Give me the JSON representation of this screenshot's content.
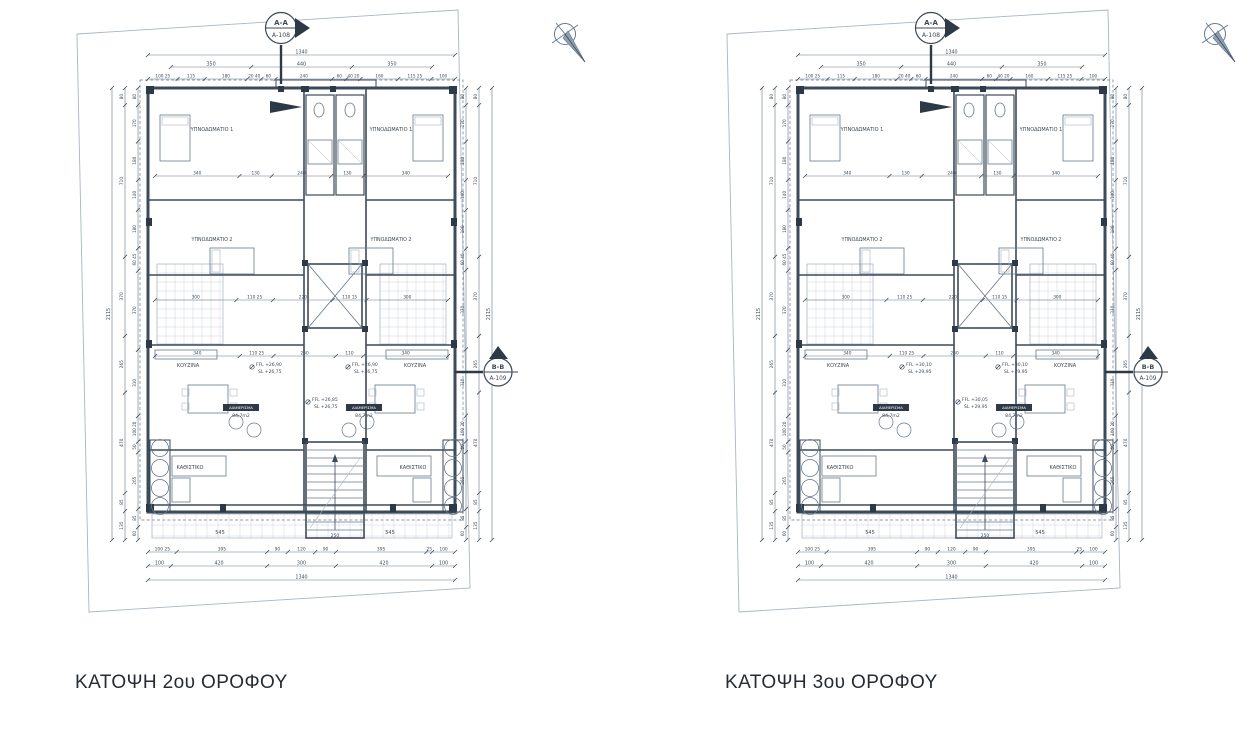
{
  "colors": {
    "line_dark": "#3d4a58",
    "line_med": "#64788c",
    "line_light": "#a8b6c4",
    "hatch": "#c5cfd9",
    "fill_dark": "#2e3948",
    "title_text": "#262c34",
    "paper": "#ffffff"
  },
  "plans": [
    {
      "title": "ΚΑΤΟΨΗ 2ου ΟΡΟΦΟΥ",
      "marker_top": {
        "name": "A-A",
        "sheet": "A-108"
      },
      "marker_side": {
        "name": "B-B",
        "sheet": "A-109"
      },
      "levels": {
        "unit_ffl": "FFL +26,90",
        "unit_sl": "SL +26,75",
        "core_ffl": "FFL +26,85",
        "core_sl": "SL +26,75"
      }
    },
    {
      "title": "ΚΑΤΟΨΗ 3ου ΟΡΟΦΟΥ",
      "marker_top": {
        "name": "A-A",
        "sheet": "A-108"
      },
      "marker_side": {
        "name": "B-B",
        "sheet": "A-109"
      },
      "levels": {
        "unit_ffl": "FFL +30,10",
        "unit_sl": "SL +29,95",
        "core_ffl": "FFL +30,05",
        "core_sl": "SL +29,95"
      }
    }
  ],
  "shared": {
    "room_labels": {
      "bedroom1": "ΥΠΝΟΔΩΜΑΤΙΟ 1",
      "bedroom2": "ΥΠΝΟΔΩΜΑΤΙΟ 2",
      "kitchen": "ΚΟΥΖΙΝΑ",
      "living": "ΚΑΘΙΣΤΙΚΟ"
    },
    "apartment": {
      "label": "ΔΙΑΜΕΡΙΣΜΑ",
      "area": "84,7m2"
    },
    "dims_top": [
      [
        "1340"
      ],
      [
        "350",
        "440",
        "350"
      ],
      [
        "100 25",
        "115",
        "180",
        "20 40",
        "60",
        "240",
        "60",
        "40 20",
        "160",
        "115 25",
        "100"
      ]
    ],
    "dims_bottom": [
      [
        "100 25",
        "395",
        "90",
        "120",
        "90",
        "395",
        "25",
        "100"
      ],
      [
        "100",
        "420",
        "300",
        "420",
        "100"
      ],
      [
        "1340"
      ]
    ],
    "dims_left_inner": [
      "80",
      "170",
      "180",
      "140",
      "180",
      "60 45",
      "370",
      "310",
      "100 20",
      "50",
      "265",
      "85",
      "60"
    ],
    "dims_left_outer": [
      "80",
      "710",
      "370",
      "265",
      "470",
      "85",
      "135"
    ],
    "dims_left_total": [
      "2115"
    ],
    "dims_right_inner": [
      "80",
      "170",
      "180",
      "140",
      "180",
      "60 40",
      "370",
      "310",
      "100 20",
      "50",
      "265",
      "85",
      "60"
    ],
    "dims_right_outer": [
      "80",
      "710",
      "370",
      "265",
      "470",
      "85",
      "135"
    ],
    "dims_right_total": [
      "2115"
    ],
    "dims_interior": [
      {
        "y": 176,
        "labels": [
          "340",
          "130",
          "240",
          "130",
          "340"
        ]
      },
      {
        "y": 300,
        "labels": [
          "300",
          "110 25",
          "220",
          "110 15",
          "300"
        ]
      },
      {
        "y": 356,
        "labels": [
          "340",
          "110 25",
          "250",
          "110",
          "340"
        ]
      }
    ],
    "balcony_labels": {
      "left": "545",
      "right": "545",
      "stair": "250"
    }
  }
}
